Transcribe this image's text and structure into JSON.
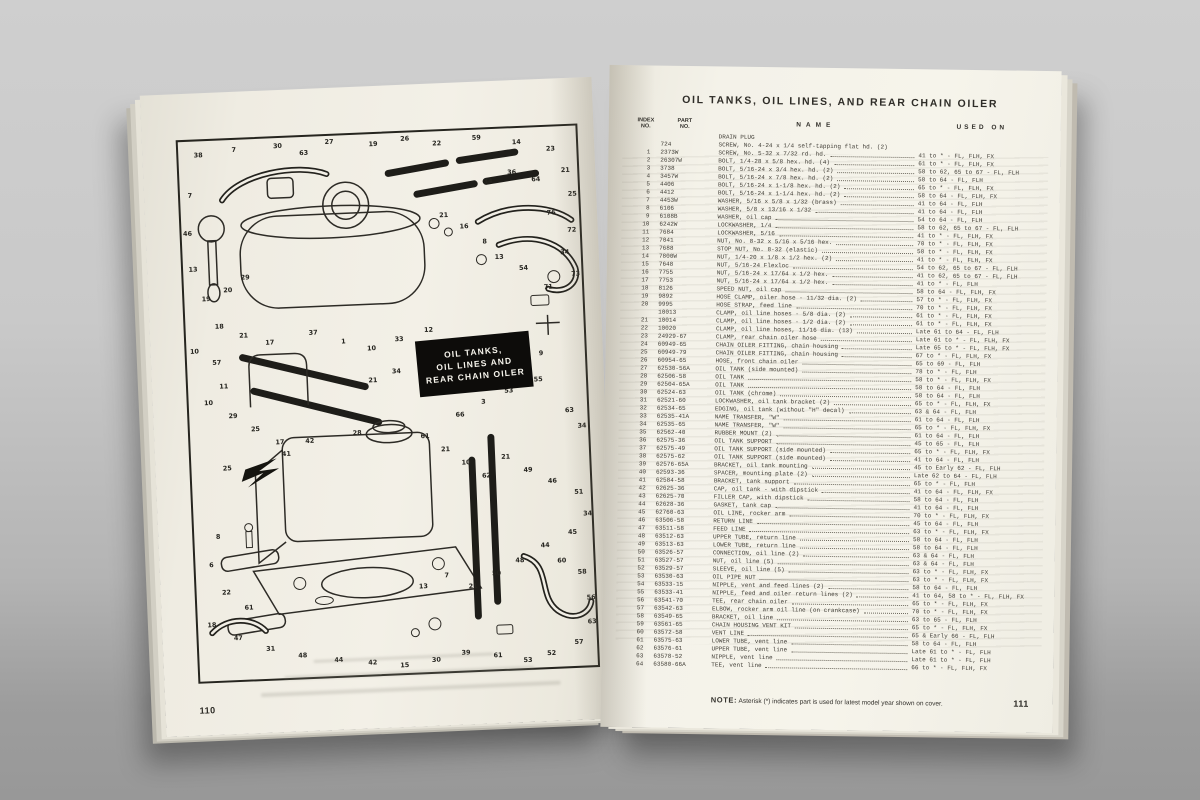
{
  "palette": {
    "surface_gray": "#bdbdbd",
    "page_cream": "#f3f0e7",
    "ink": "#2f2d28",
    "badge_bg": "#0d0c0a",
    "badge_fg": "#f6f4ec"
  },
  "left_page": {
    "page_number": "110",
    "badge": {
      "lines": [
        "OIL TANKS,",
        "OIL LINES AND",
        "REAR CHAIN OILER"
      ]
    },
    "callouts": [
      [
        20,
        16,
        "38"
      ],
      [
        56,
        12,
        "7"
      ],
      [
        100,
        10,
        "30"
      ],
      [
        126,
        18,
        "63"
      ],
      [
        152,
        8,
        "27"
      ],
      [
        196,
        12,
        "19"
      ],
      [
        228,
        8,
        "26"
      ],
      [
        260,
        14,
        "22"
      ],
      [
        300,
        10,
        "59"
      ],
      [
        340,
        16,
        "14"
      ],
      [
        374,
        24,
        "23"
      ],
      [
        388,
        46,
        "21"
      ],
      [
        358,
        54,
        "64"
      ],
      [
        334,
        46,
        "36"
      ],
      [
        310,
        54,
        "34"
      ],
      [
        394,
        70,
        "25"
      ],
      [
        372,
        88,
        "76"
      ],
      [
        392,
        106,
        "72"
      ],
      [
        384,
        128,
        "34"
      ],
      [
        394,
        150,
        "73"
      ],
      [
        366,
        162,
        "71"
      ],
      [
        342,
        142,
        "54"
      ],
      [
        318,
        130,
        "13"
      ],
      [
        304,
        114,
        "8"
      ],
      [
        284,
        98,
        "16"
      ],
      [
        264,
        86,
        "21"
      ],
      [
        10,
        56,
        "7"
      ],
      [
        6,
        94,
        "46"
      ],
      [
        10,
        130,
        "13"
      ],
      [
        22,
        160,
        "19"
      ],
      [
        44,
        152,
        "20"
      ],
      [
        62,
        140,
        "29"
      ],
      [
        34,
        188,
        "18"
      ],
      [
        58,
        198,
        "21"
      ],
      [
        84,
        206,
        "17"
      ],
      [
        8,
        212,
        "10"
      ],
      [
        30,
        224,
        "57"
      ],
      [
        128,
        198,
        "37"
      ],
      [
        158,
        208,
        "1"
      ],
      [
        186,
        216,
        "10"
      ],
      [
        214,
        208,
        "33"
      ],
      [
        244,
        200,
        "12"
      ],
      [
        262,
        216,
        "58"
      ],
      [
        238,
        230,
        "19"
      ],
      [
        210,
        240,
        "34"
      ],
      [
        186,
        248,
        "21"
      ],
      [
        258,
        246,
        "29"
      ],
      [
        286,
        234,
        "44"
      ],
      [
        310,
        224,
        "8"
      ],
      [
        336,
        214,
        "43"
      ],
      [
        356,
        228,
        "9"
      ],
      [
        352,
        254,
        "55"
      ],
      [
        322,
        264,
        "53"
      ],
      [
        296,
        274,
        "3"
      ],
      [
        272,
        286,
        "66"
      ],
      [
        382,
        286,
        "63"
      ],
      [
        394,
        302,
        "34"
      ],
      [
        36,
        248,
        "11"
      ],
      [
        20,
        264,
        "10"
      ],
      [
        44,
        278,
        "29"
      ],
      [
        66,
        292,
        "25"
      ],
      [
        90,
        306,
        "17"
      ],
      [
        36,
        330,
        "25"
      ],
      [
        120,
        306,
        "42"
      ],
      [
        96,
        318,
        "41"
      ],
      [
        168,
        300,
        "28"
      ],
      [
        236,
        306,
        "61"
      ],
      [
        256,
        320,
        "21"
      ],
      [
        276,
        334,
        "10"
      ],
      [
        296,
        348,
        "62"
      ],
      [
        316,
        330,
        "21"
      ],
      [
        338,
        344,
        "49"
      ],
      [
        362,
        356,
        "46"
      ],
      [
        388,
        368,
        "51"
      ],
      [
        396,
        390,
        "34"
      ],
      [
        380,
        408,
        "45"
      ],
      [
        352,
        420,
        "44"
      ],
      [
        326,
        434,
        "48"
      ],
      [
        302,
        446,
        "50"
      ],
      [
        278,
        458,
        "21"
      ],
      [
        252,
        446,
        "7"
      ],
      [
        228,
        456,
        "13"
      ],
      [
        24,
        398,
        "8"
      ],
      [
        16,
        426,
        "6"
      ],
      [
        30,
        454,
        "22"
      ],
      [
        52,
        470,
        "61"
      ],
      [
        14,
        486,
        "18"
      ],
      [
        40,
        500,
        "47"
      ],
      [
        72,
        512,
        "31"
      ],
      [
        104,
        520,
        "48"
      ],
      [
        140,
        526,
        "44"
      ],
      [
        174,
        530,
        "42"
      ],
      [
        206,
        534,
        "15"
      ],
      [
        238,
        530,
        "30"
      ],
      [
        268,
        524,
        "39"
      ],
      [
        300,
        528,
        "61"
      ],
      [
        330,
        534,
        "53"
      ],
      [
        354,
        528,
        "52"
      ],
      [
        382,
        518,
        "57"
      ],
      [
        396,
        498,
        "63"
      ],
      [
        396,
        474,
        "56"
      ],
      [
        388,
        448,
        "58"
      ],
      [
        368,
        436,
        "60"
      ]
    ]
  },
  "right_page": {
    "title": "OIL TANKS, OIL LINES, AND REAR CHAIN OILER",
    "columns": {
      "index": "INDEX\nNO.",
      "part": "PART\nNO.",
      "name": "NAME",
      "used_on": "USED ON"
    },
    "rows": [
      [
        "",
        "",
        "DRAIN PLUG",
        ""
      ],
      [
        "",
        "724",
        "SCREW, No. 4-24 x 1/4 self-tapping flat hd. (2)",
        ""
      ],
      [
        "1",
        "2373W",
        "SCREW, No. 5-32 x 7/32 rd. hd.",
        "41 to * - FL, FLH, FX"
      ],
      [
        "2",
        "26307W",
        "BOLT, 1/4-28 x 5/8 hex. hd. (4)",
        "61 to * - FL, FLH, FX"
      ],
      [
        "3",
        "3738",
        "BOLT, 5/16-24 x 3/4 hex. hd. (2)",
        "58 to 62, 65 to 67 - FL, FLH"
      ],
      [
        "4",
        "3457W",
        "BOLT, 5/16-24 x 7/8 hex. hd. (2)",
        "58 to 64 - FL, FLH"
      ],
      [
        "5",
        "4406",
        "BOLT, 5/16-24 x 1-1/8 hex. hd. (2)",
        "65 to * - FL, FLH, FX"
      ],
      [
        "6",
        "4412",
        "BOLT, 5/16-24 x 1-1/4 hex. hd. (2)",
        "58 to 64 - FL, FLH, FX"
      ],
      [
        "7",
        "4453W",
        "WASHER, 5/16 x 5/8 x 1/32 (brass)",
        "41 to 64 - FL, FLH"
      ],
      [
        "8",
        "6106",
        "WASHER, 5/8 x 13/16 x 1/32",
        "41 to 64 - FL, FLH"
      ],
      [
        "9",
        "6108B",
        "WASHER, oil cap",
        "54 to 64 - FL, FLH"
      ],
      [
        "10",
        "6242W",
        "LOCKWASHER, 1/4",
        "58 to 62, 65 to 67 - FL, FLH"
      ],
      [
        "11",
        "7684",
        "LOCKWASHER, 5/16",
        "41 to * - FL, FLH, FX"
      ],
      [
        "12",
        "7041",
        "NUT, No. 8-32 x 5/16 x 5/16 hex.",
        "70 to * - FL, FLH, FX"
      ],
      [
        "13",
        "7688",
        "STOP NUT, No. 8-32 (elastic)",
        "58 to * - FL, FLH, FX"
      ],
      [
        "14",
        "7800W",
        "NUT, 1/4-20 x 1/8 x 1/2 hex. (2)",
        "41 to * - FL, FLH, FX"
      ],
      [
        "15",
        "7648",
        "NUT, 5/16-24 Flexloc",
        "54 to 62, 65 to 67 - FL, FLH"
      ],
      [
        "16",
        "7755",
        "NUT, 5/16-24 x 17/64 x 1/2 hex.",
        "41 to 62, 65 to 67 - FL, FLH"
      ],
      [
        "17",
        "7753",
        "NUT, 5/16-24 x 17/64 x 1/2 hex.",
        "41 to * - FL, FLH"
      ],
      [
        "18",
        "8126",
        "SPEED NUT, oil cap",
        "58 to 64 - FL, FLH, FX"
      ],
      [
        "19",
        "9892",
        "HOSE CLAMP, oiler hose - 11/32 dia. (2)",
        "57 to * - FL, FLH, FX"
      ],
      [
        "20",
        "9995",
        "HOSE STRAP, feed line",
        "70 to * - FL, FLH, FX"
      ],
      [
        "",
        "10013",
        "CLAMP, oil line hoses - 5/8 dia. (2)",
        "61 to * - FL, FLH, FX"
      ],
      [
        "21",
        "10014",
        "CLAMP, oil line hoses - 1/2 dia. (2)",
        "61 to * - FL, FLH, FX"
      ],
      [
        "22",
        "10020",
        "CLAMP, oil line hoses, 11/16 dia. (13)",
        "Late 61 to 64 - FL, FLH"
      ],
      [
        "23",
        "24929-67",
        "CLAMP, rear chain oiler hose",
        "Late 61 to * - FL, FLH, FX"
      ],
      [
        "24",
        "60949-65",
        "CHAIN OILER FITTING, chain housing",
        "Late 65 to * - FL, FLH, FX"
      ],
      [
        "25",
        "60949-79",
        "CHAIN OILER FITTING, chain housing",
        "67 to * - FL, FLH, FX"
      ],
      [
        "26",
        "60954-65",
        "HOSE, front chain oiler",
        "65 to 69 - FL, FLH"
      ],
      [
        "27",
        "62530-56A",
        "OIL TANK (side mounted)",
        "78 to * - FL, FLH"
      ],
      [
        "28",
        "62506-58",
        "OIL TANK",
        "58 to * - FL, FLH, FX"
      ],
      [
        "29",
        "62504-65A",
        "OIL TANK",
        "58 to 64 - FL, FLH"
      ],
      [
        "30",
        "62524-63",
        "OIL TANK (chrome)",
        "58 to 64 - FL, FLH"
      ],
      [
        "31",
        "62521-60",
        "LOCKWASHER, oil tank bracket (2)",
        "65 to * - FL, FLH, FX"
      ],
      [
        "32",
        "62534-65",
        "EDGING, oil tank (without \"H\" decal)",
        "63 & 64 - FL, FLH"
      ],
      [
        "33",
        "62535-41A",
        "NAME TRANSFER, \"W\"",
        "61 to 64 - FL, FLH"
      ],
      [
        "34",
        "62535-65",
        "NAME TRANSFER, \"W\"",
        "65 to * - FL, FLH, FX"
      ],
      [
        "35",
        "62562-40",
        "RUBBER MOUNT (2)",
        "61 to 64 - FL, FLH"
      ],
      [
        "36",
        "62575-36",
        "OIL TANK SUPPORT",
        "45 to 65 - FL, FLH"
      ],
      [
        "37",
        "62575-49",
        "OIL TANK SUPPORT (side mounted)",
        "65 to * - FL, FLH, FX"
      ],
      [
        "38",
        "62575-62",
        "OIL TANK SUPPORT (side mounted)",
        "41 to 64 - FL, FLH"
      ],
      [
        "39",
        "62576-65A",
        "BRACKET, oil tank mounting",
        "45 to Early 62 - FL, FLH"
      ],
      [
        "40",
        "62593-36",
        "SPACER, mounting plate (2)",
        "Late 62 to 64 - FL, FLH"
      ],
      [
        "41",
        "62584-58",
        "BRACKET, tank support",
        "65 to * - FL, FLH"
      ],
      [
        "42",
        "62625-36",
        "CAP, oil tank - with dipstick",
        "41 to 64 - FL, FLH, FX"
      ],
      [
        "43",
        "62625-70",
        "FILLER CAP, with dipstick",
        "58 to 64 - FL, FLH"
      ],
      [
        "44",
        "62628-36",
        "GASKET, tank cap",
        "41 to 64 - FL, FLH"
      ],
      [
        "45",
        "62760-63",
        "OIL LINE, rocker arm",
        "70 to * - FL, FLH, FX"
      ],
      [
        "46",
        "63506-58",
        "RETURN LINE",
        "45 to 64 - FL, FLH"
      ],
      [
        "47",
        "63511-58",
        "FEED LINE",
        "63 to * - FL, FLH, FX"
      ],
      [
        "48",
        "63512-63",
        "UPPER TUBE, return line",
        "58 to 64 - FL, FLH"
      ],
      [
        "49",
        "63513-63",
        "LOWER TUBE, return line",
        "58 to 64 - FL, FLH"
      ],
      [
        "50",
        "63526-57",
        "CONNECTION, oil line (2)",
        "63 & 64 - FL, FLH"
      ],
      [
        "51",
        "63527-57",
        "NUT, oil line (5)",
        "63 & 64 - FL, FLH"
      ],
      [
        "52",
        "63529-57",
        "SLEEVE, oil line (5)",
        "63 to * - FL, FLH, FX"
      ],
      [
        "53",
        "63530-63",
        "OIL PIPE NUT",
        "63 to * - FL, FLH, FX"
      ],
      [
        "54",
        "63533-15",
        "NIPPLE, vent and feed lines (2)",
        "58 to 64 - FL, FLH"
      ],
      [
        "55",
        "63533-41",
        "NIPPLE, feed and oiler return lines (2)",
        "41 to 64, 58 to * - FL, FLH, FX"
      ],
      [
        "56",
        "63541-70",
        "TEE, rear chain oiler",
        "65 to * - FL, FLH, FX"
      ],
      [
        "57",
        "63542-63",
        "ELBOW, rocker arm oil line (on crankcase)",
        "70 to * - FL, FLH, FX"
      ],
      [
        "58",
        "63549-65",
        "BRACKET, oil line",
        "63 to 65 - FL, FLH"
      ],
      [
        "59",
        "63561-65",
        "CHAIN HOUSING VENT KIT",
        "65 to * - FL, FLH, FX"
      ],
      [
        "60",
        "63572-58",
        "VENT LINE",
        "65 & Early 66 - FL, FLH"
      ],
      [
        "61",
        "63575-63",
        "LOWER TUBE, vent line",
        "58 to 64 - FL, FLH"
      ],
      [
        "62",
        "63576-61",
        "UPPER TUBE, vent line",
        "Late 61 to * - FL, FLH"
      ],
      [
        "63",
        "63578-52",
        "NIPPLE, vent line",
        "Late 61 to * - FL, FLH"
      ],
      [
        "64",
        "63580-66A",
        "TEE, vent line",
        "66 to * - FL, FLH, FX"
      ]
    ],
    "note_label": "NOTE:",
    "note_text": "Asterisk (*) indicates part is used for latest model year shown on cover.",
    "page_number": "111"
  }
}
